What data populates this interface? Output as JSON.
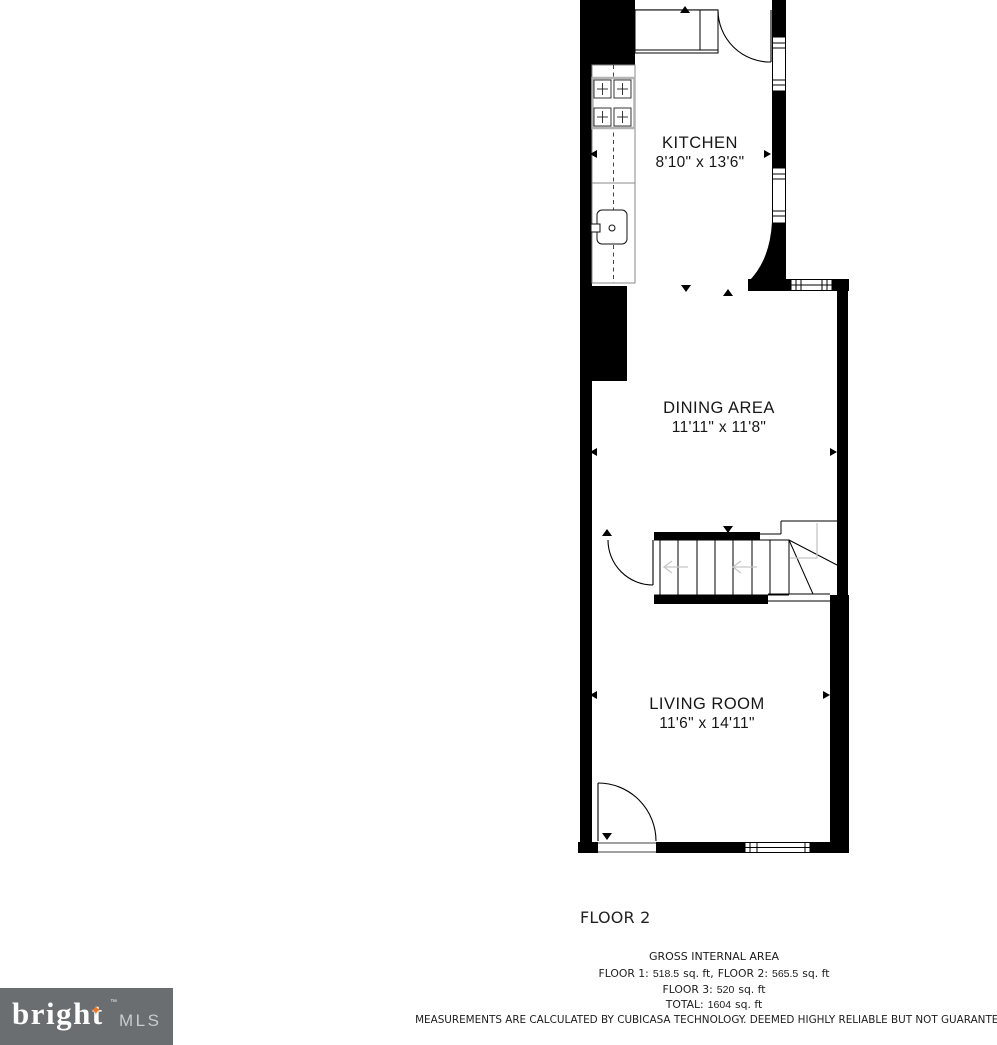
{
  "plan": {
    "floor_title": "FLOOR 2",
    "rooms": [
      {
        "name": "KITCHEN",
        "dims": "8'10\" x 13'6\""
      },
      {
        "name": "DINING AREA",
        "dims": "11'11\" x 11'8\""
      },
      {
        "name": "LIVING ROOM",
        "dims": "11'6\" x 14'11\""
      }
    ]
  },
  "footer": {
    "gross_title": "GROSS INTERNAL AREA",
    "line_floors": {
      "f1_label": "FLOOR 1:",
      "f1_value": "518.5",
      "f1_unit": "sq. ft,",
      "f2_label": "FLOOR 2:",
      "f2_value": "565.5",
      "f2_unit": "sq. ft"
    },
    "line_floor3": {
      "label": "FLOOR 3:",
      "value": "520",
      "unit": "sq. ft"
    },
    "line_total": {
      "label": "TOTAL:",
      "value": "1604",
      "unit": "sq. ft"
    },
    "disclaimer": "MEASUREMENTS ARE CALCULATED BY CUBICASA TECHNOLOGY. DEEMED HIGHLY RELIABLE BUT NOT GUARANTEED"
  },
  "logo": {
    "brand": "bright",
    "tm": "™",
    "suffix": "MLS",
    "star": "✦"
  },
  "colors": {
    "wall": "#000000",
    "stair_guide": "#c6c6c6",
    "logo_bg": "#6b6e70",
    "logo_star": "#ed7523",
    "logo_mls_text": "#c9cbcc"
  }
}
